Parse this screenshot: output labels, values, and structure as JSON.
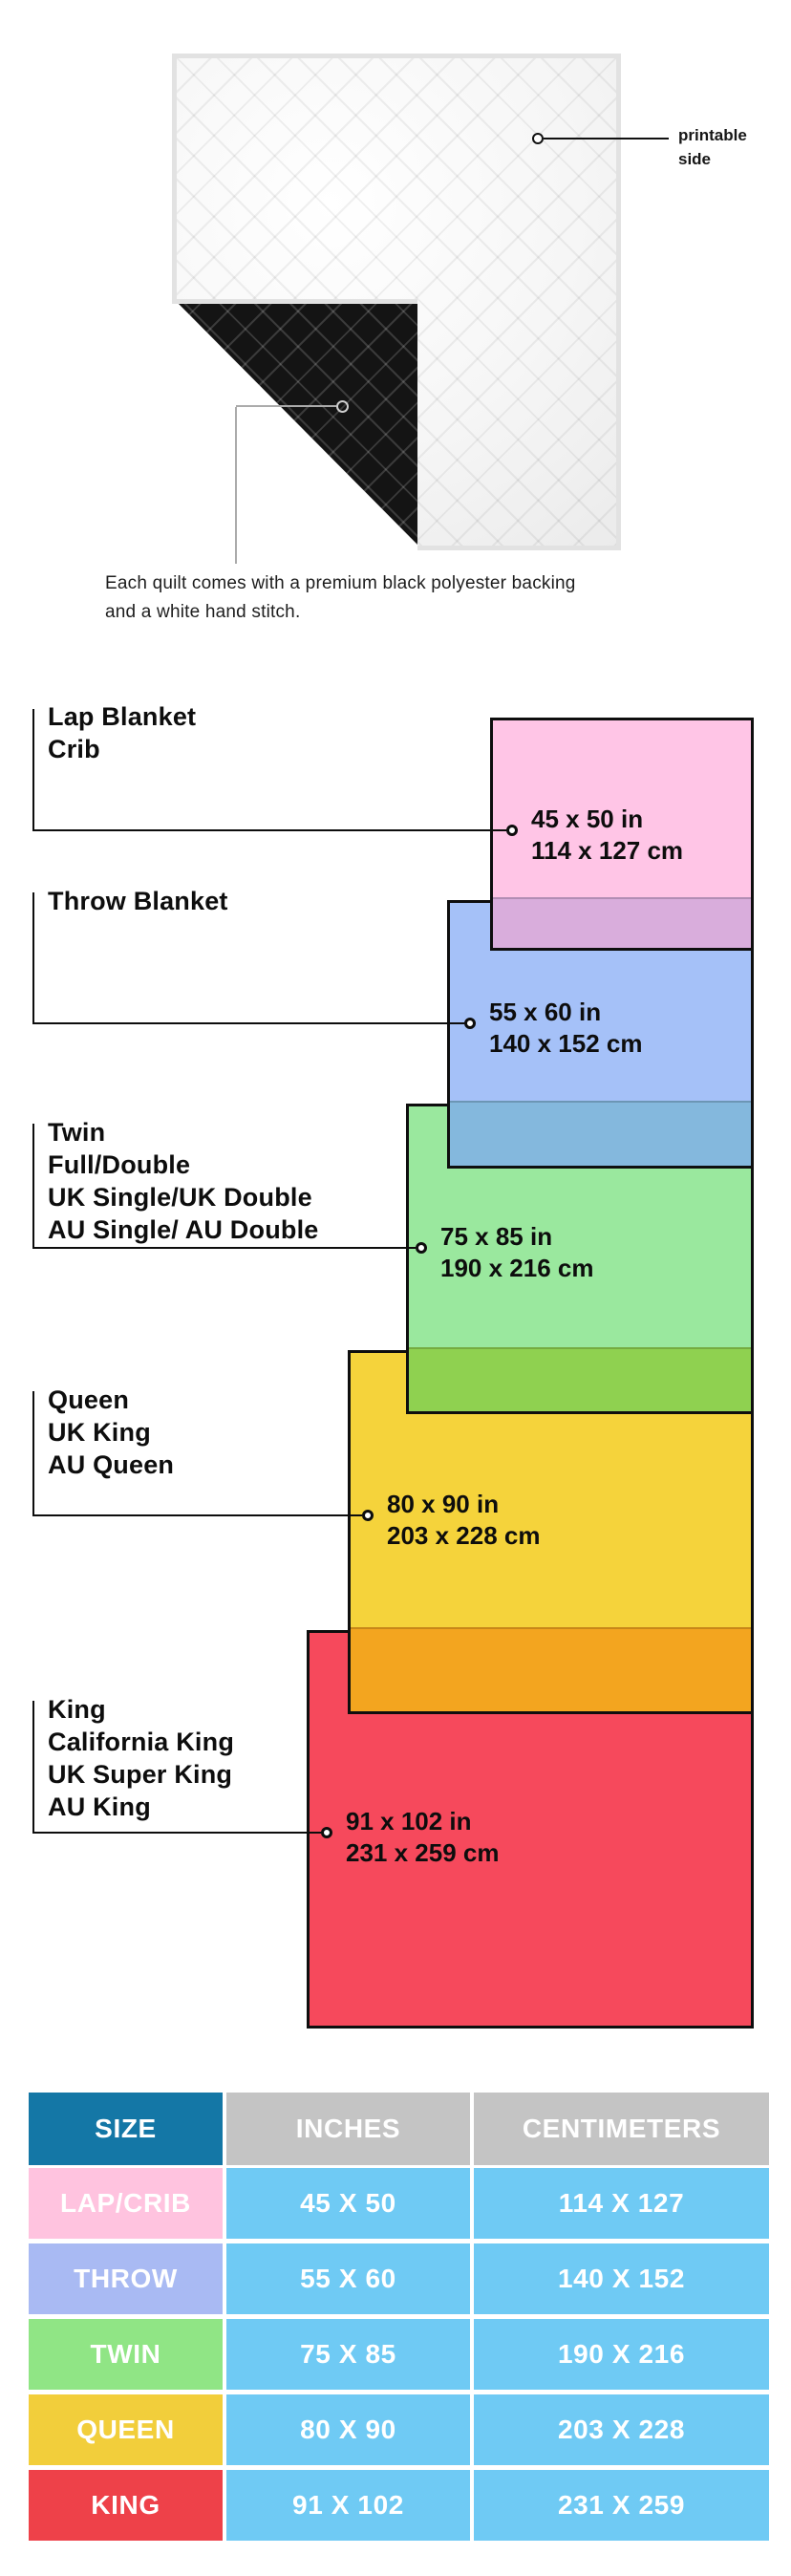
{
  "quilt_photo": {
    "printable_side_label": "printable side",
    "caption": "Each quilt comes with a premium black polyester backing and a white hand stitch.",
    "front_color": "#ffffff",
    "backing_color": "#141414"
  },
  "diagram": {
    "sizes": [
      {
        "id": "lap",
        "names": [
          "Lap Blanket",
          "Crib"
        ],
        "inches": "45 x 50 in",
        "cm": "114 x 127 cm",
        "color": "#FFC5E6",
        "overlap_color": "#D9ADDC"
      },
      {
        "id": "throw",
        "names": [
          "Throw Blanket"
        ],
        "inches": "55 x 60 in",
        "cm": "140 x 152 cm",
        "color": "#A5C1F8",
        "overlap_color": "#84B8DD"
      },
      {
        "id": "twin",
        "names": [
          "Twin",
          "Full/Double",
          "UK Single/UK Double",
          "AU Single/ AU Double"
        ],
        "inches": "75 x 85 in",
        "cm": "190 x 216 cm",
        "color": "#9AE89E",
        "overlap_color": "#8FD150"
      },
      {
        "id": "queen",
        "names": [
          "Queen",
          "UK King",
          "AU Queen"
        ],
        "inches": "80 x 90 in",
        "cm": "203 x 228 cm",
        "color": "#F5D33B",
        "overlap_color": "#F3A51F"
      },
      {
        "id": "king",
        "names": [
          "King",
          "California King",
          "UK Super King",
          "AU King"
        ],
        "inches": "91 x 102 in",
        "cm": "231 x 259 cm",
        "color": "#F6495C",
        "overlap_color": null
      }
    ]
  },
  "table": {
    "headers": [
      "SIZE",
      "INCHES",
      "CENTIMETERS"
    ],
    "header_size_color": "#1477A6",
    "header_other_color": "#C4C4C4",
    "value_cell_color": "#6FCAF4",
    "rows": [
      {
        "size": "LAP/CRIB",
        "inches": "45 X 50",
        "centimeters": "114 X 127",
        "color": "#FFC3DF"
      },
      {
        "size": "THROW",
        "inches": "55 X 60",
        "centimeters": "140 X 152",
        "color": "#A9BAF3"
      },
      {
        "size": "TWIN",
        "inches": "75 X 85",
        "centimeters": "190 X 216",
        "color": "#90E585"
      },
      {
        "size": "QUEEN",
        "inches": "80 X 90",
        "centimeters": "203 X 228",
        "color": "#F2CE3B"
      },
      {
        "size": "KING",
        "inches": "91 X 102",
        "centimeters": "231 X 259",
        "color": "#EE4149"
      }
    ]
  }
}
